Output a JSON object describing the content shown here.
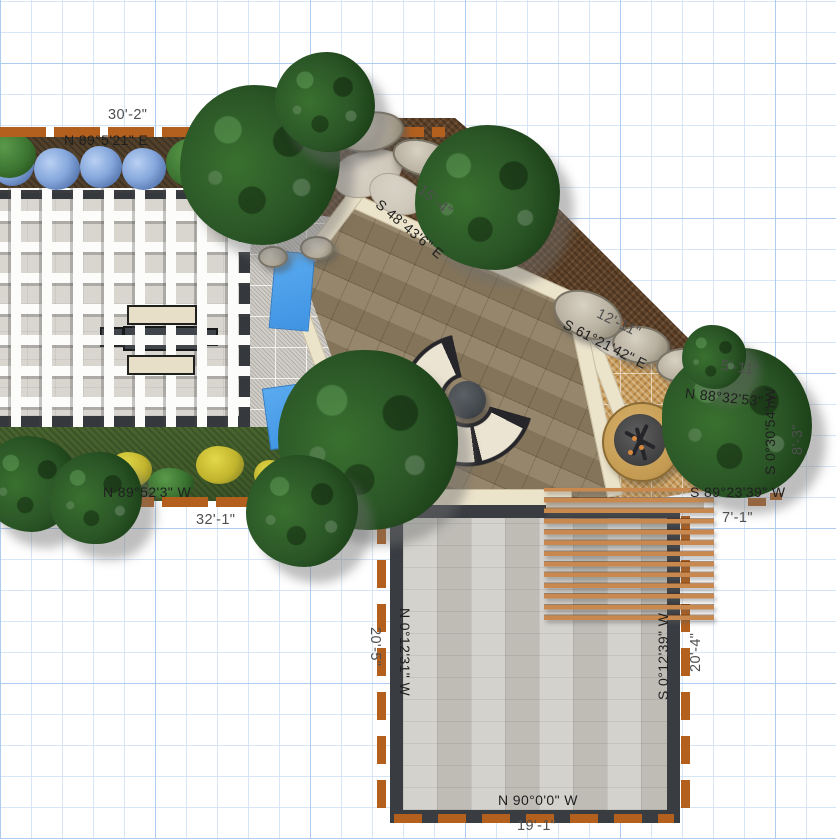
{
  "plan": {
    "annotations": [
      {
        "id": "dim-top",
        "type": "dimension",
        "text": "30'-2\""
      },
      {
        "id": "bearing-top",
        "type": "bearing",
        "text": "N 89°5'21\" E"
      },
      {
        "id": "dim-ne-1",
        "type": "dimension",
        "text": "15'-4\""
      },
      {
        "id": "bearing-ne-1",
        "type": "bearing",
        "text": "S 48°43'6\" E"
      },
      {
        "id": "dim-ne-2",
        "type": "dimension",
        "text": "12'-11\""
      },
      {
        "id": "bearing-ne-2",
        "type": "bearing",
        "text": "S 61°21'42\" E"
      },
      {
        "id": "dim-e-1",
        "type": "dimension",
        "text": "5'-11\""
      },
      {
        "id": "bearing-e-1",
        "type": "bearing",
        "text": "N 88°32'53\" E"
      },
      {
        "id": "bearing-e-2",
        "type": "bearing",
        "text": "S 0°30'54\" W"
      },
      {
        "id": "dim-e-2",
        "type": "dimension",
        "text": "8'-3\""
      },
      {
        "id": "bearing-e-3",
        "type": "bearing",
        "text": "S 89°23'39\" W"
      },
      {
        "id": "dim-e-3",
        "type": "dimension",
        "text": "7'-1\""
      },
      {
        "id": "bearing-w",
        "type": "bearing",
        "text": "N 89°52'3\" W"
      },
      {
        "id": "dim-w",
        "type": "dimension",
        "text": "32'-1\""
      },
      {
        "id": "dim-patio-left",
        "type": "dimension",
        "text": "20'-5\""
      },
      {
        "id": "bearing-patio-left",
        "type": "bearing",
        "text": "N 0°12'31\" W"
      },
      {
        "id": "bearing-patio-right",
        "type": "bearing",
        "text": "S 0°12'39\" W"
      },
      {
        "id": "dim-patio-right",
        "type": "dimension",
        "text": "20'-4\""
      },
      {
        "id": "bearing-patio-bottom",
        "type": "bearing",
        "text": "N 90°0'0\" W"
      },
      {
        "id": "dim-patio-bottom",
        "type": "dimension",
        "text": "19'-1\""
      }
    ],
    "palette": {
      "grid_minor": "#cde0f5",
      "grid_major": "#a8c8ee",
      "edging_orange": "#b35f1d",
      "pergola_beam_white": "#fcfcfb",
      "dark_paver_border": "#393d42",
      "tan_paver": "#8e7d60",
      "cream_stone": "#ece3cb",
      "gold_gravel": "#c79a57",
      "gray_paver": "#c8c6bf",
      "water_blue": "#459ae6",
      "tree_canopy": "#2a5526",
      "bench_cushion": "#ece4d2",
      "bench_frame": "#26262a",
      "wood_slat": "#c9894e",
      "mulch_brown": "#5d4128"
    },
    "objects": [
      {
        "name": "shade-pergola-room"
      },
      {
        "name": "hydrangea-bed"
      },
      {
        "name": "flower-bed"
      },
      {
        "name": "curved-bench"
      },
      {
        "name": "fire-table"
      },
      {
        "name": "stone-fire-pit"
      },
      {
        "name": "gold-gravel-court"
      },
      {
        "name": "tan-paver-patio"
      },
      {
        "name": "gray-paver-patio"
      },
      {
        "name": "wood-slat-pergola"
      },
      {
        "name": "water-features"
      },
      {
        "name": "boulders"
      },
      {
        "name": "trees"
      }
    ]
  }
}
